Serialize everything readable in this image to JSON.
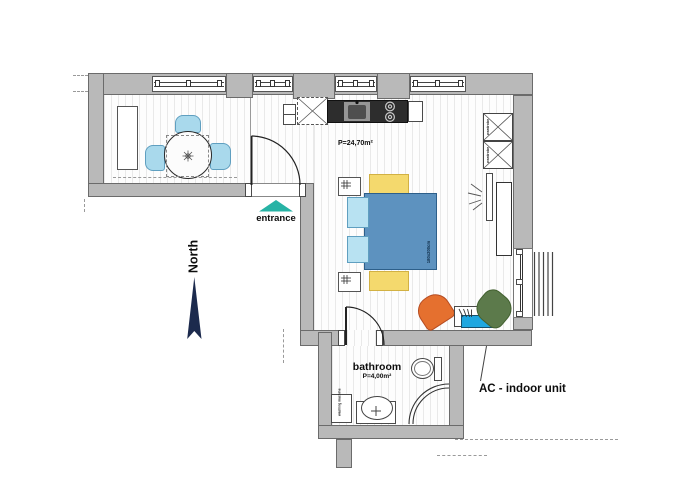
{
  "labels": {
    "entrance": "entrance",
    "north": "North",
    "main_room_area": "P=24,70m²",
    "bathroom": "bathroom",
    "bathroom_area": "P=4,00m²",
    "ac_indoor_unit": "AC - indoor unit",
    "wardrobe_1": "wardrobe",
    "wardrobe_2": "wardrobe",
    "bed_size": "180x200cm",
    "washing_machine": "washing machine"
  },
  "colors": {
    "wall": "#b9b9b9",
    "floor_stripe": "#e9e9e9",
    "entrance_marker": "#27b3a5",
    "north_arrow": "#1c2a4d",
    "bed": "#5d92bf",
    "pillow": "#b8e2f2",
    "dining_chair": "#a9d9ec",
    "bedside_rug": "#f4d96d",
    "armchair_orange": "#e5702f",
    "armchair_green": "#5c7a4b",
    "ac_unit": "#1fa7e0",
    "kitchen_counter": "#2d2d2d"
  },
  "icons": {
    "entrance_marker": "triangle-up",
    "north_arrow": "arrow-up",
    "table_ornament": "flower"
  }
}
